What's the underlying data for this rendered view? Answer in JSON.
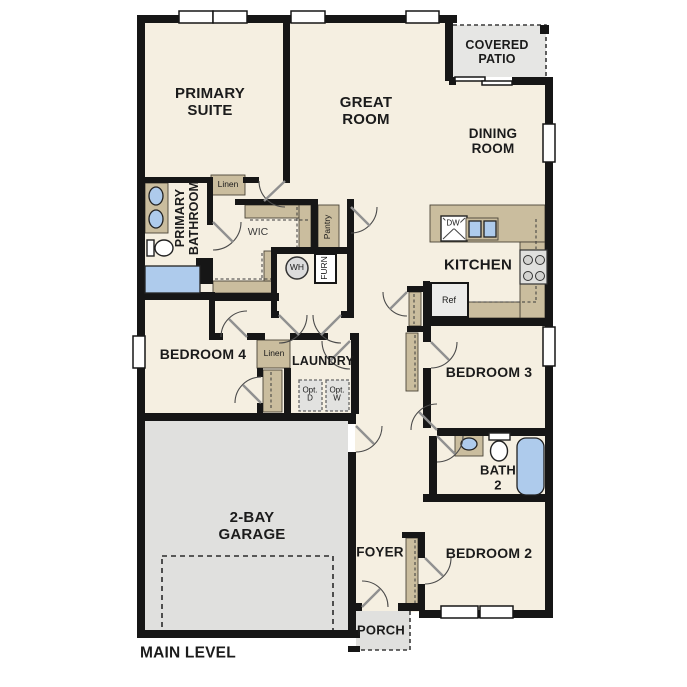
{
  "plan_title": "MAIN LEVEL",
  "rooms": {
    "primary_suite": "PRIMARY\nSUITE",
    "great_room": "GREAT\nROOM",
    "dining_room": "DINING\nROOM",
    "covered_patio": "COVERED\nPATIO",
    "kitchen": "KITCHEN",
    "primary_bathroom": "PRIMARY\nBATHROOM",
    "wic": "WIC",
    "bedroom_4": "BEDROOM 4",
    "laundry": "LAUNDRY",
    "bedroom_3": "BEDROOM 3",
    "bath_2": "BATH\n2",
    "bedroom_2": "BEDROOM 2",
    "garage": "2-BAY\nGARAGE",
    "foyer": "FOYER",
    "porch": "PORCH"
  },
  "fixtures": {
    "linen_hall": "Linen",
    "linen_bedroom4": "Linen",
    "pantry": "Pantry",
    "water_heater": "WH",
    "furnace": "FURN",
    "opt_dryer": "Opt.\nD",
    "opt_washer": "Opt.\nW",
    "refrigerator": "Ref",
    "dishwasher": "DW"
  },
  "colors": {
    "floor": "#f5efe1",
    "wall": "#161616",
    "cabinet_tan": "#cabd9e",
    "garage_floor": "#e0e0de",
    "patio_floor": "#e6e6e4",
    "fixture_blue": "#aecbec",
    "appliance_gray": "#ececea"
  }
}
